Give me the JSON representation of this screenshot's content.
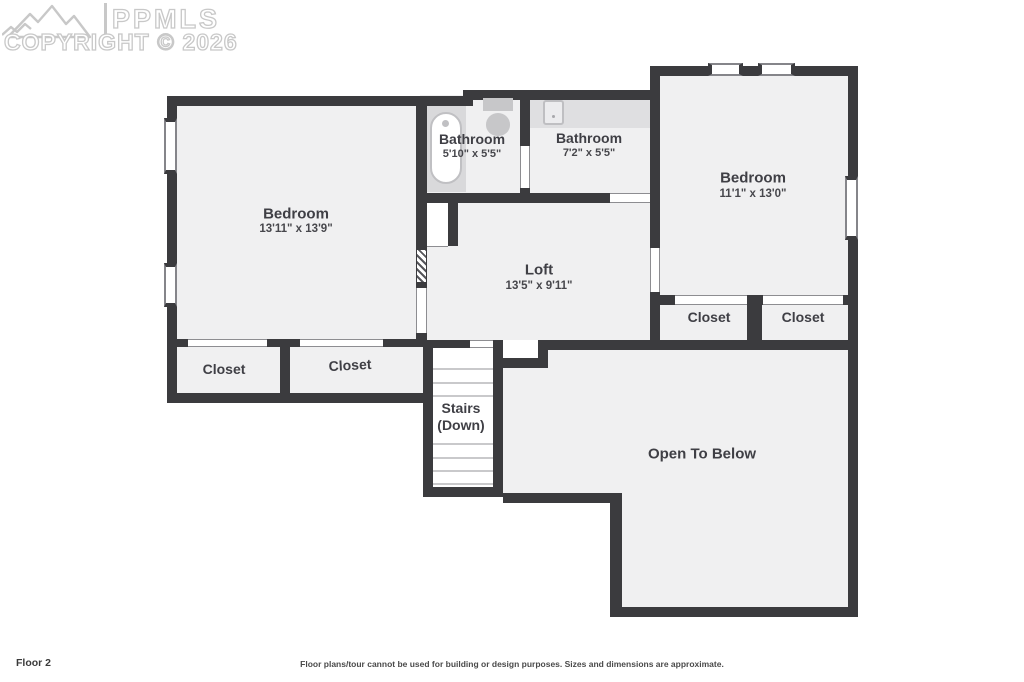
{
  "watermark": {
    "brand": "PPMLS",
    "copyright": "COPYRIGHT © 2026",
    "logo": "mountains-icon",
    "color": "#c8c8c8"
  },
  "rooms": {
    "bedroom_left": {
      "name": "Bedroom",
      "dims": "13'11\" x 13'9\""
    },
    "bathroom_left": {
      "name": "Bathroom",
      "dims": "5'10\" x 5'5\""
    },
    "bathroom_right": {
      "name": "Bathroom",
      "dims": "7'2\" x 5'5\""
    },
    "bedroom_right": {
      "name": "Bedroom",
      "dims": "11'1\" x 13'0\""
    },
    "loft": {
      "name": "Loft",
      "dims": "13'5\" x 9'11\""
    },
    "closet_left_1": {
      "name": "Closet"
    },
    "closet_left_2": {
      "name": "Closet"
    },
    "closet_right_1": {
      "name": "Closet"
    },
    "closet_right_2": {
      "name": "Closet"
    },
    "stairs": {
      "line1": "Stairs",
      "line2": "(Down)"
    },
    "open_to_below": {
      "name": "Open To Below"
    }
  },
  "fixtures": {
    "tub": "bathtub-icon",
    "toilet": "toilet-icon",
    "sink": "sink-icon"
  },
  "footer": {
    "floor_label": "Floor 2",
    "disclaimer": "Floor plans/tour cannot be used for building or design purposes. Sizes and dimensions are approximate."
  },
  "colors": {
    "wall": "#3b3b3e",
    "floor": "#f0f0f1",
    "fixture": "#c7c7c9",
    "surface": "#d9d9db",
    "text": "#3f3f45"
  }
}
